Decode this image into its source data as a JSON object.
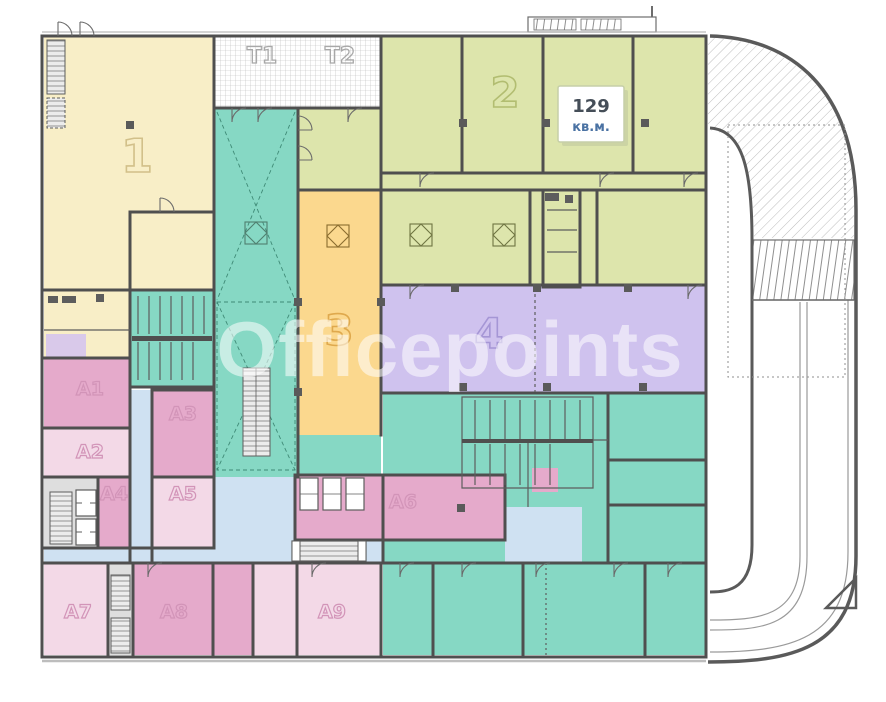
{
  "watermark": "Officepoints",
  "badge": {
    "area": "129",
    "unit": "кв.м."
  },
  "zones": {
    "z1": {
      "label": "1"
    },
    "z2": {
      "label": "2"
    },
    "z3": {
      "label": "3"
    },
    "z4": {
      "label": "4"
    },
    "t1": {
      "label": "T1"
    },
    "t2": {
      "label": "T2"
    },
    "a1": {
      "label": "A1"
    },
    "a2": {
      "label": "A2"
    },
    "a3": {
      "label": "A3"
    },
    "a4": {
      "label": "A4"
    },
    "a5": {
      "label": "A5"
    },
    "a6": {
      "label": "A6"
    },
    "a7": {
      "label": "A7"
    },
    "a8": {
      "label": "A8"
    },
    "a9": {
      "label": "A9"
    }
  },
  "colors": {
    "wall": "#4f4f4f",
    "cream": "#f8eec7",
    "olive": "#dde5ac",
    "orange": "#fbd88e",
    "purple": "#cfc2ee",
    "teal": "#86d8c4",
    "pink": "#e5aacb",
    "pink_light": "#f3d9e7",
    "corridor_blue": "#cfe1f2",
    "gray_zone": "#dedede",
    "lavender_small": "#d9c9ea",
    "label_cream": "#d2c08a",
    "label_olive": "#b2bd71",
    "label_orange": "#dfa94d",
    "label_purple": "#a596d5",
    "label_pink": "#d294b8",
    "label_gray": "#a8a8a8",
    "badge_number": "#454e58",
    "badge_unit": "#4a72a3",
    "badge_border": "#c6cfa8"
  }
}
